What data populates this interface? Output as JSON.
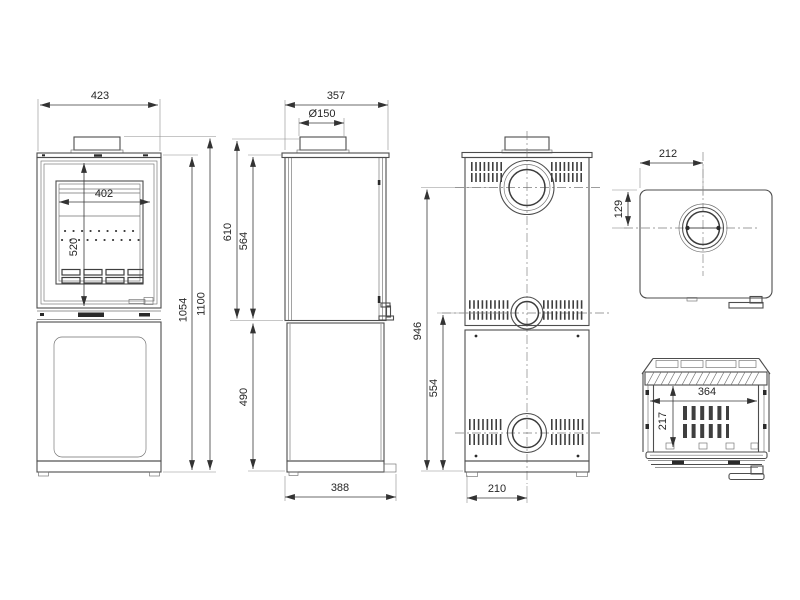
{
  "meta": {
    "background": "#ffffff",
    "line_color": "#4d4d4d",
    "dimension_text_color": "#262626"
  },
  "dims": {
    "front_width": "423",
    "front_glass_width": "402",
    "front_door_height": "520",
    "front_body_height": "1054",
    "front_total_height": "1100",
    "side_depth": "357",
    "side_flue_diameter": "Ø150",
    "side_collar_top_height": "610",
    "side_upper_section_height": "564",
    "side_pedestal_height": "490",
    "side_base_depth": "388",
    "rear_flue_centre_height": "946",
    "rear_lower_outlet_height": "554",
    "rear_outlet_offset": "210",
    "top_flue_offset_from_side": "212",
    "top_flue_offset_from_back": "129",
    "firebox_interior_width": "364",
    "firebox_interior_height": "217"
  }
}
